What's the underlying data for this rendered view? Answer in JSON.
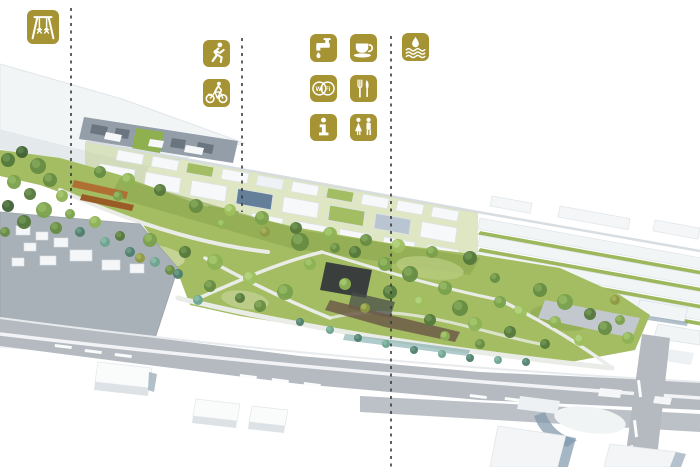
{
  "colors": {
    "icon_gold": "#A59334",
    "icon_glyph": "#FFFFFF",
    "divider_line": "#3A3A3A",
    "park_green": "#A4BD62",
    "road_gray": "#B4BAC0",
    "building_white": "#F3F5F6"
  },
  "legend": {
    "groups": [
      {
        "title_icons": [
          "playground"
        ]
      },
      {
        "title_icons": [
          "running",
          "cycling"
        ]
      },
      {
        "title_icons": [
          "drinking-water",
          "cafe",
          "wifi",
          "restaurant",
          "information",
          "toilets"
        ]
      },
      {
        "title_icons": [
          "water-feature"
        ]
      }
    ],
    "icons": [
      {
        "name": "swing-playground-icon",
        "glyph": "swing",
        "x": 27,
        "y": 10,
        "w": 32,
        "h": 34
      },
      {
        "name": "running-icon",
        "glyph": "runner",
        "x": 203,
        "y": 40,
        "w": 27,
        "h": 27
      },
      {
        "name": "cycling-icon",
        "glyph": "bicycle",
        "x": 203,
        "y": 79,
        "w": 27,
        "h": 28
      },
      {
        "name": "drinking-water-icon",
        "glyph": "tap",
        "x": 310,
        "y": 34,
        "w": 27,
        "h": 28
      },
      {
        "name": "cafe-icon",
        "glyph": "coffee",
        "x": 350,
        "y": 34,
        "w": 27,
        "h": 28
      },
      {
        "name": "wifi-icon",
        "glyph": "wifi",
        "x": 310,
        "y": 75,
        "w": 27,
        "h": 27,
        "text": "Wi Fi"
      },
      {
        "name": "restaurant-icon",
        "glyph": "cutlery",
        "x": 350,
        "y": 75,
        "w": 27,
        "h": 27
      },
      {
        "name": "information-icon",
        "glyph": "info",
        "x": 310,
        "y": 114,
        "w": 27,
        "h": 27
      },
      {
        "name": "toilets-icon",
        "glyph": "toilets",
        "x": 350,
        "y": 114,
        "w": 27,
        "h": 27
      },
      {
        "name": "water-feature-icon",
        "glyph": "waves",
        "x": 402,
        "y": 33,
        "w": 27,
        "h": 28
      }
    ],
    "divider_lines": [
      {
        "x": 71,
        "y1": 8,
        "y2": 205
      },
      {
        "x": 242,
        "y1": 38,
        "y2": 212
      },
      {
        "x": 391,
        "y1": 36,
        "y2": 467
      }
    ]
  }
}
